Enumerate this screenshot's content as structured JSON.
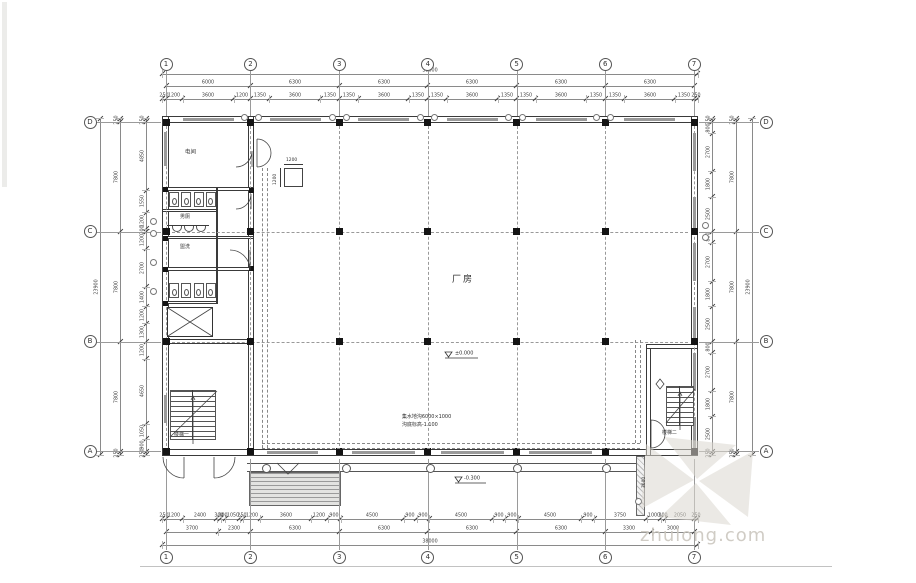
{
  "plan": {
    "hall_label": "厂房",
    "rooms": {
      "power_room": "电间",
      "mens_toilet": "男厕",
      "wash_area": "盥洗",
      "stair_left": "楼梯一",
      "stair_right": "楼梯二"
    },
    "elevations": {
      "hall": "±0.000",
      "porch": "-0.300"
    },
    "notes": {
      "trench_line1": "集水地沟6000×1000",
      "trench_line2": "沟底标高-1.100",
      "porch_strip_dim": "3600"
    },
    "column_detail": {
      "top": "1200",
      "side": "1200"
    },
    "grid": {
      "vertical_labels": [
        "1",
        "2",
        "3",
        "4",
        "5",
        "6",
        "7"
      ],
      "horizontal_labels": [
        "D",
        "C",
        "B",
        "A"
      ]
    },
    "dims": {
      "top_overall": [
        38000
      ],
      "top_bays": [
        6000,
        6300,
        6300,
        6300,
        6300,
        6300
      ],
      "top_detail": [
        250,
        1200,
        3600,
        1200,
        1350,
        3600,
        1350,
        1350,
        3600,
        1350,
        1350,
        3600,
        1350,
        1350,
        3600,
        1350,
        1350,
        3600,
        1350,
        250
      ],
      "bottom_detail": [
        250,
        1200,
        2400,
        300,
        300,
        1050,
        250,
        1200,
        3600,
        1200,
        900,
        4500,
        900,
        900,
        4500,
        900,
        900,
        4500,
        900,
        3750,
        1000,
        300,
        2050,
        250
      ],
      "bottom_bays": [
        3700,
        2300,
        6300,
        6300,
        6300,
        6300,
        3300,
        3000
      ],
      "bottom_overall": [
        38000
      ],
      "left_detail": [
        250,
        4850,
        1550,
        1200,
        200,
        1200,
        2700,
        1400,
        1200,
        1300,
        1200,
        4650,
        1050,
        900,
        250
      ],
      "left_mid": [
        250,
        7800,
        7800,
        7800,
        250
      ],
      "left_overall": [
        23900
      ],
      "right_detail": [
        250,
        800,
        2700,
        1800,
        2500,
        800,
        2700,
        1800,
        2500,
        800,
        2700,
        1800,
        2500,
        250
      ],
      "right_mid": [
        250,
        7800,
        7800,
        7800,
        250
      ],
      "right_overall": [
        23900
      ]
    },
    "watermark": {
      "text": "zhulong.com"
    }
  }
}
